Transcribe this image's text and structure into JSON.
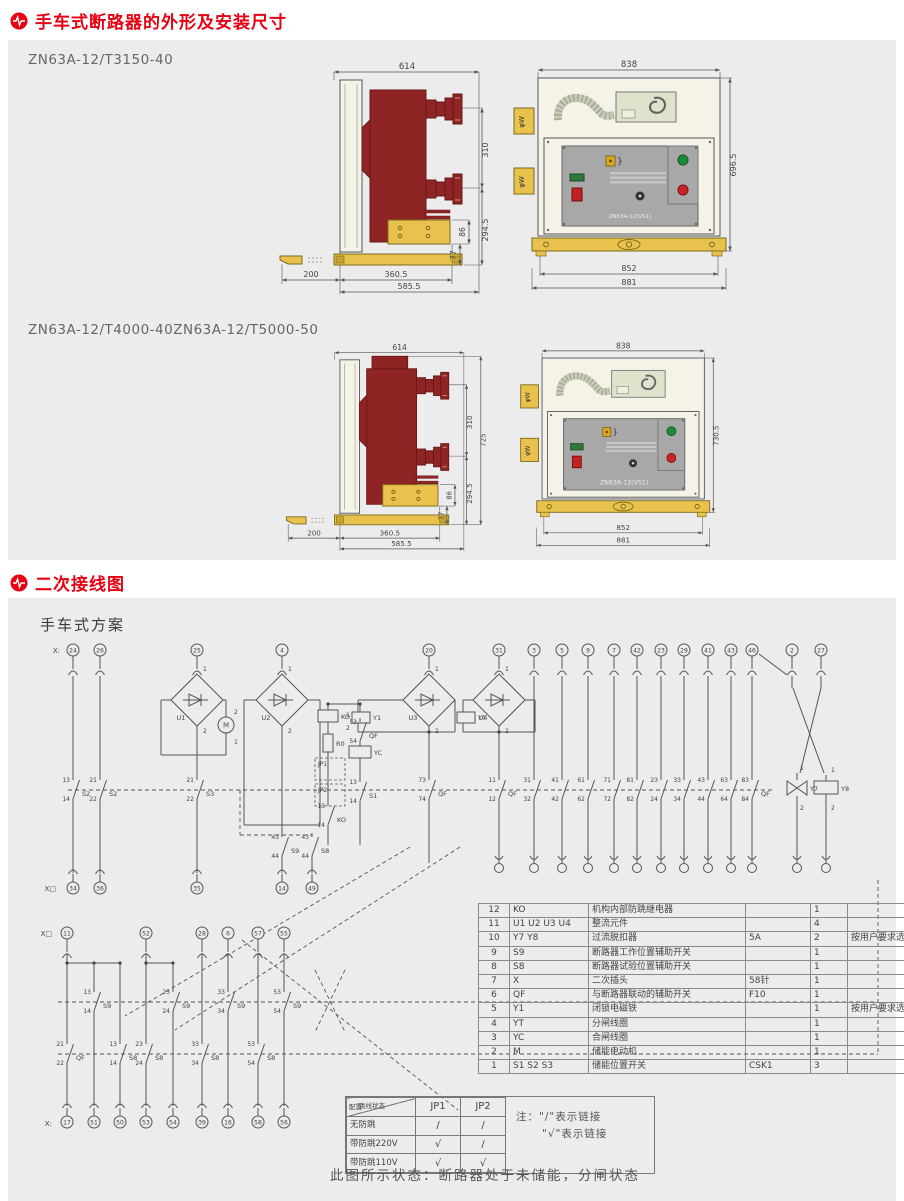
{
  "palette": {
    "accent": "#e60012",
    "panel_bg": "#ececec",
    "line": "#555555",
    "maroon": "#8e2424",
    "maroon_dark": "#6b1717",
    "yellow": "#e8c24d",
    "cream": "#f5f3e8",
    "gray_panel": "#a8a8a8",
    "hook_green": "#dfe3cc"
  },
  "section_outline": {
    "title": "手车式断路器的外形及安装尺寸",
    "model1": "ZN63A-12/T3150-40",
    "model2a": "ZN63A-12/T4000-40",
    "model2b": "ZN63A-12/T5000-50",
    "side1": {
      "d614": "614",
      "d310": "310",
      "d294": "294.5",
      "d86": "86",
      "d77": "77",
      "d200": "200",
      "d360": "360.5",
      "d585": "585.5"
    },
    "front1": {
      "d838": "838",
      "dh": "696.5",
      "d852": "852",
      "d881": "881",
      "tab": "φW",
      "nameplate": "ZN63A-12(VS1)"
    },
    "side2": {
      "d614": "614",
      "d310": "310",
      "d725": "725",
      "d294": "294.5",
      "d86": "86",
      "d77": "77",
      "d200": "200",
      "d360": "360.5",
      "d585": "585.5"
    },
    "front2": {
      "d838": "838",
      "dh": "730.5",
      "d852": "852",
      "d881": "881",
      "tab": "φW",
      "nameplate": "ZN63A-12(VS1)"
    }
  },
  "section_wiring": {
    "title": "二次接线图",
    "scheme": "手车式方案",
    "caption": "此图所示状态：断路器处于未储能，分闸状态",
    "jumper": {
      "corner_a": "跳线状态",
      "corner_b": "配置",
      "cols": [
        "JP1",
        "JP2"
      ],
      "rows": [
        [
          "无防跳",
          "/",
          "/"
        ],
        [
          "带防跳220V",
          "√",
          "/"
        ],
        [
          "带防跳110V",
          "√",
          "√"
        ]
      ],
      "note1": "注：\"/\"表示链接",
      "note2": "\"√\"表示链接"
    },
    "component_table": {
      "rows": [
        [
          "12",
          "KO",
          "机构内部防跳继电器",
          "",
          "1",
          ""
        ],
        [
          "11",
          "U1 U2 U3 U4",
          "整流元件",
          "",
          "4",
          ""
        ],
        [
          "10",
          "Y7 Y8",
          "过流脱扣器",
          "5A",
          "2",
          "按用户要求选配"
        ],
        [
          "9",
          "S9",
          "断路器工作位置辅助开关",
          "",
          "1",
          ""
        ],
        [
          "8",
          "S8",
          "断路器试验位置辅助开关",
          "",
          "1",
          ""
        ],
        [
          "7",
          "X",
          "二次插头",
          "58针",
          "1",
          ""
        ],
        [
          "6",
          "QF",
          "与断路器联动的辅助开关",
          "F10",
          "1",
          ""
        ],
        [
          "5",
          "Y1",
          "闭锁电磁铁",
          "",
          "1",
          "按用户要求选配"
        ],
        [
          "4",
          "YT",
          "分闸线圈",
          "",
          "1",
          ""
        ],
        [
          "3",
          "YC",
          "合闸线圈",
          "",
          "1",
          ""
        ],
        [
          "2",
          "M",
          "储能电动机",
          "",
          "1",
          ""
        ],
        [
          "1",
          "S1 S2 S3",
          "储能位置开关",
          "CSK1",
          "3",
          ""
        ]
      ]
    },
    "schematic": {
      "row_labels": {
        "top": "X:",
        "rowA": "X□",
        "rowB": "X□",
        "bottom": "X:"
      },
      "top": [
        {
          "n": "24",
          "x": 43
        },
        {
          "n": "26",
          "x": 70
        },
        {
          "n": "25",
          "x": 167
        },
        {
          "n": "4",
          "x": 252
        },
        {
          "n": "20",
          "x": 399
        },
        {
          "n": "31",
          "x": 469
        },
        {
          "n": "3",
          "x": 504
        },
        {
          "n": "5",
          "x": 532
        },
        {
          "n": "9",
          "x": 558
        },
        {
          "n": "7",
          "x": 584
        },
        {
          "n": "42",
          "x": 607
        },
        {
          "n": "23",
          "x": 631
        },
        {
          "n": "29",
          "x": 654
        },
        {
          "n": "41",
          "x": 678
        },
        {
          "n": "43",
          "x": 701
        },
        {
          "n": "46",
          "x": 722
        },
        {
          "n": "2",
          "x": 762
        },
        {
          "n": "27",
          "x": 791
        }
      ],
      "rowA": [
        {
          "n": "34",
          "x": 43
        },
        {
          "n": "36",
          "x": 70
        },
        {
          "n": "35",
          "x": 167
        },
        {
          "n": "14",
          "x": 252
        },
        {
          "n": "49",
          "x": 282
        }
      ],
      "rowB": [
        {
          "n": "11",
          "x": 37
        },
        {
          "n": "52",
          "x": 116
        },
        {
          "n": "28",
          "x": 172
        },
        {
          "n": "6",
          "x": 198
        },
        {
          "n": "57",
          "x": 228
        },
        {
          "n": "55",
          "x": 254
        }
      ],
      "bottom": [
        {
          "n": "17",
          "x": 37
        },
        {
          "n": "51",
          "x": 64
        },
        {
          "n": "50",
          "x": 90
        },
        {
          "n": "53",
          "x": 116
        },
        {
          "n": "54",
          "x": 143
        },
        {
          "n": "39",
          "x": 172
        },
        {
          "n": "16",
          "x": 198
        },
        {
          "n": "58",
          "x": 228
        },
        {
          "n": "56",
          "x": 254
        }
      ],
      "right_mid_xs": [
        469,
        504,
        532,
        558,
        584,
        607,
        631,
        654,
        678,
        701,
        722,
        767,
        796
      ],
      "diamonds": [
        {
          "cx": 167,
          "cy": 60,
          "t": "U1"
        },
        {
          "cx": 252,
          "cy": 60,
          "t": "U2"
        },
        {
          "cx": 399,
          "cy": 60,
          "t": "U3"
        },
        {
          "cx": 469,
          "cy": 60,
          "t": "U4"
        }
      ],
      "coils": [
        {
          "x": 288,
          "y": 70,
          "w": 20,
          "h": 12,
          "t": "KO"
        },
        {
          "x": 319,
          "y": 106,
          "w": 22,
          "h": 12,
          "t": "YC"
        },
        {
          "x": 322,
          "y": 72,
          "w": 18,
          "h": 11,
          "t": "Y1"
        },
        {
          "x": 427,
          "y": 72,
          "w": 18,
          "h": 11,
          "t": "YT"
        },
        {
          "x": 784,
          "y": 141,
          "w": 24,
          "h": 13,
          "t": "Y8"
        }
      ],
      "resistor": {
        "x": 293,
        "y": 94,
        "w": 10,
        "h": 18,
        "t": "R0"
      },
      "jp_boxes": [
        {
          "x": 285,
          "y": 118,
          "w": 30,
          "h": 22,
          "t": "JP1"
        },
        {
          "x": 285,
          "y": 144,
          "w": 30,
          "h": 22,
          "t": "JP2"
        }
      ],
      "motor": {
        "cx": 196,
        "cy": 85,
        "r": 8,
        "t": "M"
      },
      "y7": {
        "x": 767,
        "y": 148,
        "t": "Y7",
        "p1": "1",
        "p2": "2"
      },
      "y8_pins": {
        "p1": "1",
        "p2": "2"
      },
      "contacts": [
        {
          "x": 43,
          "y": 150,
          "a": "13",
          "b": "14",
          "r": "S2"
        },
        {
          "x": 70,
          "y": 150,
          "a": "21",
          "b": "22",
          "r": "S2"
        },
        {
          "x": 167,
          "y": 150,
          "a": "21",
          "b": "22",
          "r": "S3"
        },
        {
          "x": 399,
          "y": 150,
          "a": "73",
          "b": "74",
          "r": "QF"
        },
        {
          "x": 469,
          "y": 150,
          "a": "11",
          "b": "12",
          "r": "QF"
        },
        {
          "x": 504,
          "y": 150,
          "a": "31",
          "b": "32",
          "r": ""
        },
        {
          "x": 532,
          "y": 150,
          "a": "41",
          "b": "42",
          "r": ""
        },
        {
          "x": 558,
          "y": 150,
          "a": "61",
          "b": "62",
          "r": ""
        },
        {
          "x": 584,
          "y": 150,
          "a": "71",
          "b": "72",
          "r": ""
        },
        {
          "x": 607,
          "y": 150,
          "a": "81",
          "b": "82",
          "r": ""
        },
        {
          "x": 631,
          "y": 150,
          "a": "23",
          "b": "24",
          "r": ""
        },
        {
          "x": 654,
          "y": 150,
          "a": "33",
          "b": "34",
          "r": ""
        },
        {
          "x": 678,
          "y": 150,
          "a": "43",
          "b": "44",
          "r": ""
        },
        {
          "x": 701,
          "y": 150,
          "a": "63",
          "b": "64",
          "r": ""
        },
        {
          "x": 722,
          "y": 150,
          "a": "83",
          "b": "84",
          "r": "QF"
        },
        {
          "x": 252,
          "y": 207,
          "a": "43",
          "b": "44",
          "r": "S9"
        },
        {
          "x": 282,
          "y": 207,
          "a": "43",
          "b": "44",
          "r": "S8"
        },
        {
          "x": 330,
          "y": 92,
          "a": "53",
          "b": "54",
          "r": "QF"
        },
        {
          "x": 330,
          "y": 152,
          "a": "13",
          "b": "14",
          "r": "S1"
        },
        {
          "x": 298,
          "y": 176,
          "a": "13",
          "b": "14",
          "r": "KO"
        },
        {
          "x": 64,
          "y": 362,
          "a": "13",
          "b": "14",
          "r": "S9"
        },
        {
          "x": 143,
          "y": 362,
          "a": "23",
          "b": "24",
          "r": "S9"
        },
        {
          "x": 198,
          "y": 362,
          "a": "33",
          "b": "34",
          "r": "S9"
        },
        {
          "x": 254,
          "y": 362,
          "a": "53",
          "b": "54",
          "r": "S9"
        },
        {
          "x": 90,
          "y": 414,
          "a": "13",
          "b": "14",
          "r": "S8"
        },
        {
          "x": 116,
          "y": 414,
          "a": "23",
          "b": "24",
          "r": "S8"
        },
        {
          "x": 172,
          "y": 414,
          "a": "33",
          "b": "34",
          "r": "S8"
        },
        {
          "x": 228,
          "y": 414,
          "a": "53",
          "b": "54",
          "r": "S8"
        },
        {
          "x": 37,
          "y": 414,
          "a": "21",
          "b": "22",
          "r": "QF"
        }
      ],
      "pin_labels": [
        {
          "t": "2",
          "x": 204,
          "y": 74
        },
        {
          "t": "1",
          "x": 204,
          "y": 104
        },
        {
          "t": "1",
          "x": 316,
          "y": 77
        },
        {
          "t": "2",
          "x": 316,
          "y": 90
        },
        {
          "t": "1",
          "x": 770,
          "y": 130
        },
        {
          "t": "2",
          "x": 770,
          "y": 170
        },
        {
          "t": "1",
          "x": 801,
          "y": 132
        },
        {
          "t": "2",
          "x": 801,
          "y": 170
        }
      ]
    }
  }
}
